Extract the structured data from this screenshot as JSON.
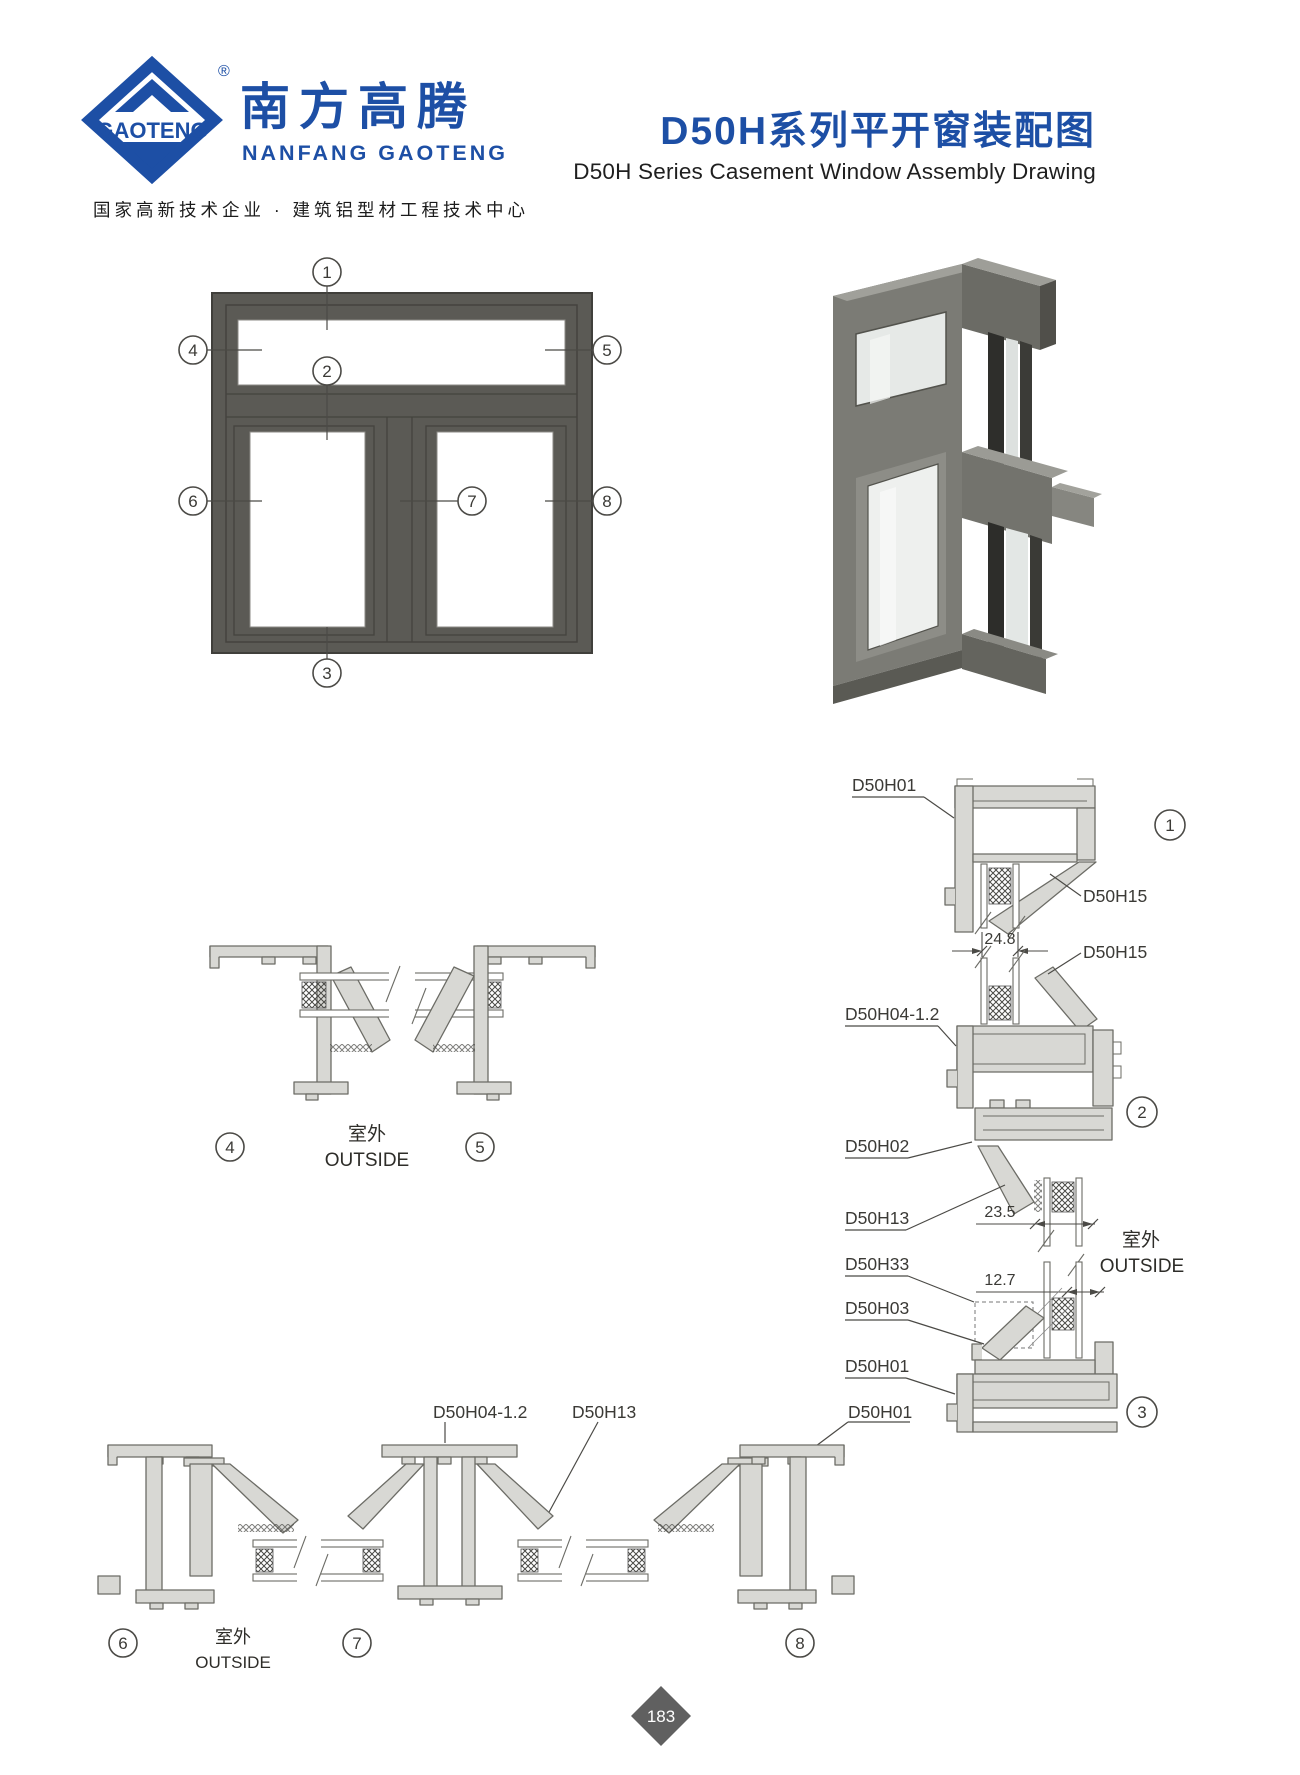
{
  "header": {
    "logo": {
      "brand_latin": "GAOTENG",
      "registered_mark": "®",
      "brand_cjk": "南方高腾",
      "brand_sub": "NANFANG GAOTENG",
      "tagline": "国家高新技术企业 · 建筑铝型材工程技术中心"
    },
    "title_cjk": "D50H系列平开窗装配图",
    "title_en": "D50H Series Casement Window Assembly Drawing"
  },
  "elevation": {
    "callouts": {
      "c1": "1",
      "c2": "2",
      "c3": "3",
      "c4": "4",
      "c5": "5",
      "c6": "6",
      "c7": "7",
      "c8": "8"
    }
  },
  "mid_section": {
    "callout_left": "4",
    "callout_right": "5",
    "outside_cjk": "室外",
    "outside_en": "OUTSIDE"
  },
  "right_details": {
    "labels": {
      "head_frame": "D50H01",
      "bead_top": "D50H15",
      "bead_transom": "D50H15",
      "transom": "D50H04-1.2",
      "sash_top": "D50H02",
      "bead_sash": "D50H13",
      "gasket": "D50H33",
      "bead_bottom": "D50H03",
      "sill_frame": "D50H01"
    },
    "dims": {
      "glass_unit": "24.8",
      "glazing_pocket": "23.5",
      "single_glass": "12.7"
    },
    "callouts": {
      "head": "1",
      "transom": "2",
      "sill": "3"
    },
    "outside_cjk": "室外",
    "outside_en": "OUTSIDE"
  },
  "bottom_section": {
    "labels": {
      "mullion": "D50H04-1.2",
      "bead": "D50H13",
      "frame": "D50H01"
    },
    "callouts": {
      "left": "6",
      "middle": "7",
      "right": "8"
    },
    "outside_cjk": "室外",
    "outside_en": "OUTSIDE"
  },
  "footer": {
    "page_number": "183"
  }
}
